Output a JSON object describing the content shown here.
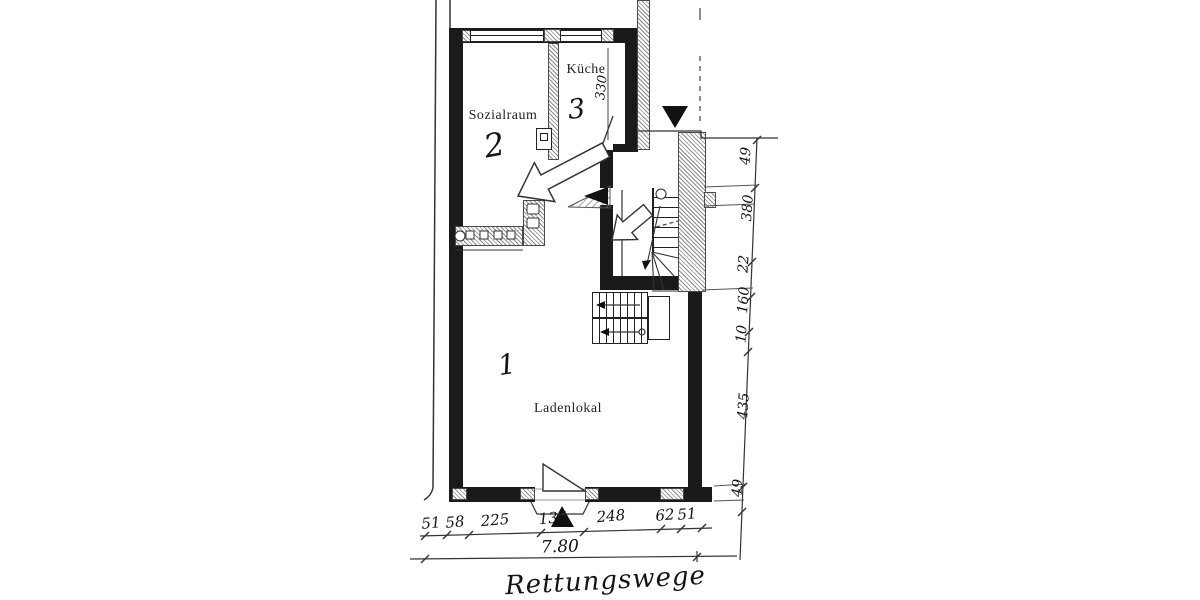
{
  "drawing": {
    "type": "floor-plan-sketch",
    "caption": "Rettungswege",
    "rooms": [
      {
        "name": "Ladenlokal",
        "number": "1"
      },
      {
        "name": "Sozialraum",
        "number": "2"
      },
      {
        "name": "Küche",
        "number": "3"
      }
    ],
    "dimensions": {
      "kueche_depth": "330",
      "right_chain": [
        "49",
        "380",
        "22",
        "160",
        "10",
        "435",
        "49"
      ],
      "bottom_chain": [
        "51",
        "58",
        "225",
        "135",
        "248",
        "62",
        "51"
      ],
      "total_width": "7.80"
    },
    "icons": {
      "entrance_marker": "filled-triangle-arrow",
      "escape_route": "open-outline-arrow"
    },
    "colors": {
      "ink": "#1a1a1a",
      "paper": "#ffffff",
      "hatch": "#777777"
    }
  }
}
